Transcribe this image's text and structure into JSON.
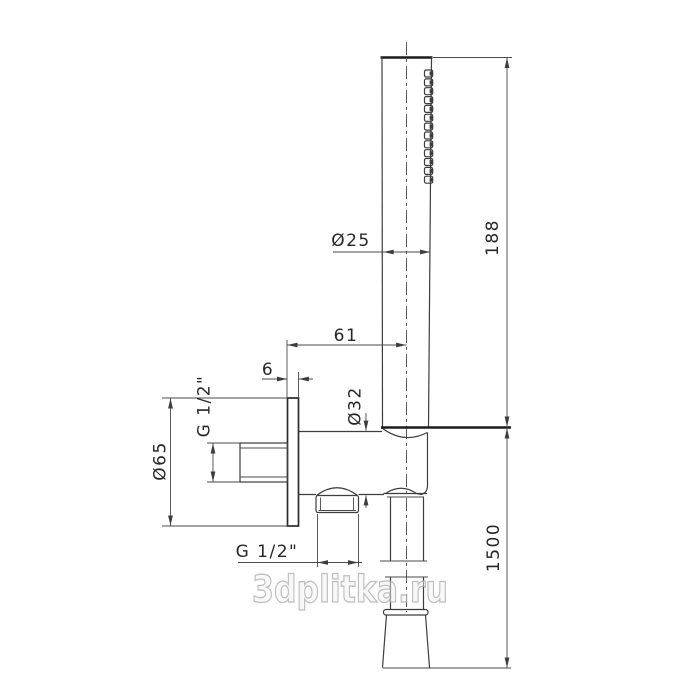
{
  "drawing": {
    "type": "technical-drawing",
    "subject": "Hand shower set with wall outlet elbow, holder and hose - dimensioned side view",
    "nozzle_count": 13,
    "dimensions": {
      "handle_diameter": "Ø25",
      "handle_length": "188",
      "wall_to_center_offset": "61",
      "plate_thickness": "6",
      "holder_diameter": "Ø32",
      "plate_diameter": "Ø65",
      "inlet_thread": "G 1/2\"",
      "hose_thread": "G 1/2\"",
      "hose_length": "1500"
    },
    "watermark": {
      "text": "3dplitka.ru",
      "color": "#b2b2b2"
    },
    "colors": {
      "line": "#3d3d3d",
      "line_bold": "#1c1c1c",
      "background": "#ffffff"
    }
  }
}
